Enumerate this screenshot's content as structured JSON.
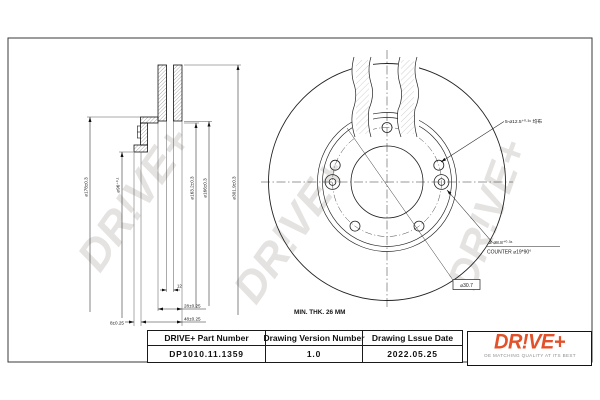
{
  "watermark_text": "DR!VE+",
  "section_view": {
    "dia_labels": [
      "⌀178±0.3",
      "⌀96⁺⁰·¹",
      "⌀163.2±0.3",
      "⌀166±0.3",
      "⌀301.9±0.3"
    ],
    "vent_width": "12",
    "thickness": "28±0.25",
    "overall_height": "48±0.25",
    "flange_thickness": "8±0.25"
  },
  "front_view": {
    "bolt_holes_note": "5-⌀12.5⁺⁰·³⁶ 均布",
    "countersink_note_line1": "2-⌀8.8⁺⁰·³⁶",
    "countersink_note_line2": "COUNTER ⌀19*90°",
    "min_thickness_note": "MIN. THK. 26 MM",
    "ref_dim": "⌀30.7"
  },
  "title_block": {
    "col1_header": "DRIVE+ Part Number",
    "col2_header": "Drawing Version Number",
    "col3_header": "Drawing Lssue Date",
    "part_number": "DP1010.11.1359",
    "version": "1.0",
    "issue_date": "2022.05.25"
  },
  "logo": {
    "brand": "DR!VE+",
    "tagline": "OE MATCHING QUALITY AT ITS BEST"
  },
  "colors": {
    "brand_orange": "#e2512a",
    "line_black": "#1a1a1a",
    "watermark_gray": "#d4d1ce"
  }
}
